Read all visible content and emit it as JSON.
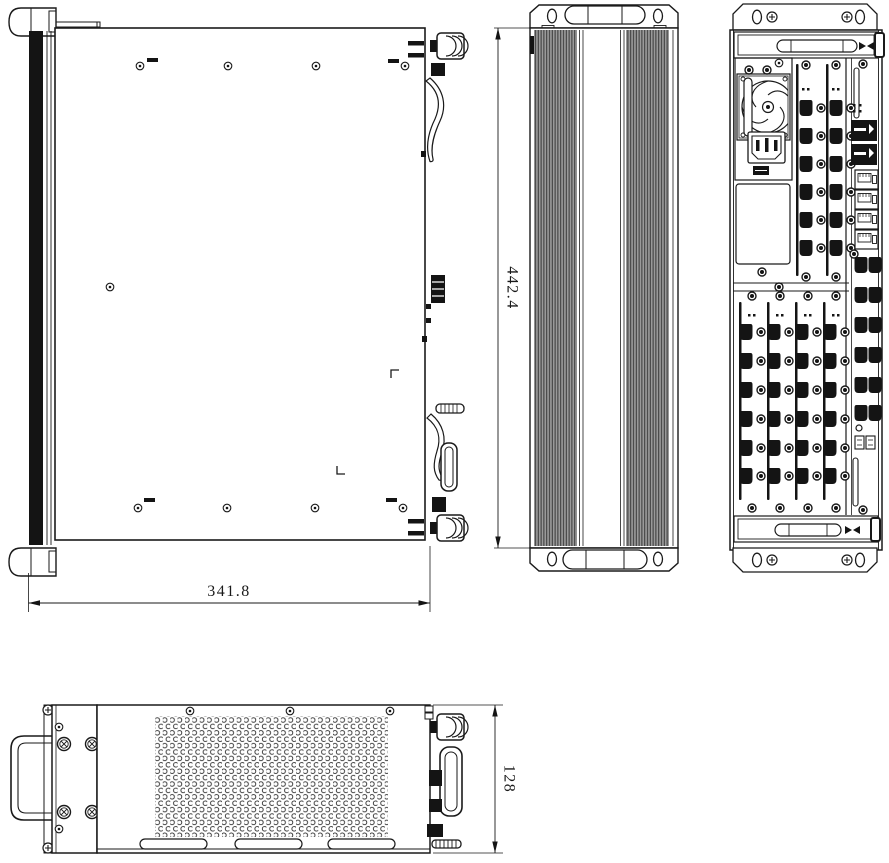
{
  "drawing": {
    "background": "#ffffff",
    "line_color": "#1a1a1a",
    "fin_fill": "#9a9a9a",
    "dimensions": [
      {
        "view": "top",
        "value": "341.8"
      },
      {
        "view": "side",
        "value": "442.4"
      },
      {
        "view": "front",
        "value": "128"
      }
    ]
  }
}
